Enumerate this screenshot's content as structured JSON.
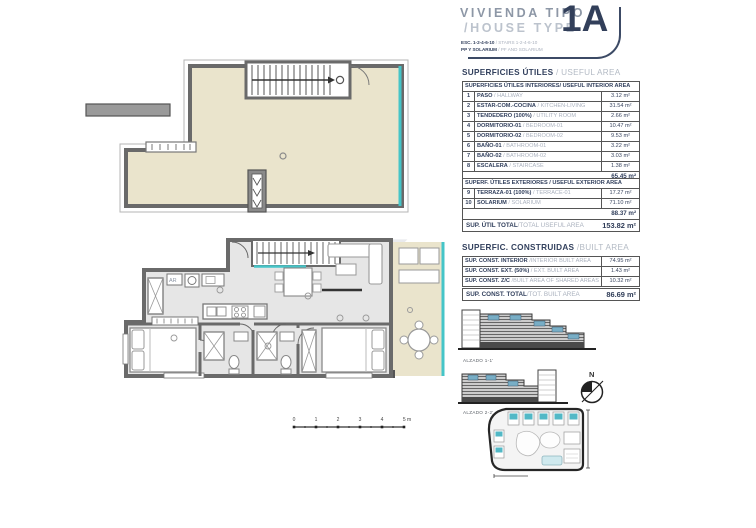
{
  "title": {
    "line1": "VIVIENDA TIPO",
    "line2": "/HOUSE TYPE",
    "unit_code": "1A",
    "sub1_es": "ESC. 1-2-4-6-10",
    "sub1_en": " / STAIRS 1-2-4-6-10",
    "sub2_es": "PP Y SOLARIUM",
    "sub2_en": " / PF AND SOLARIUM"
  },
  "useful_area": {
    "heading_es": "SUPERFICIES ÚTILES",
    "heading_en": " / USEFUL AREA",
    "interior_header": "SUPERFICIES ÚTILES INTERIORES/ USEFUL INTERIOR AREA",
    "interior_rows": [
      {
        "num": "1",
        "es": "PASO",
        "en": " / HALLWAY",
        "val": "3.12 m²"
      },
      {
        "num": "2",
        "es": "ESTAR-COM.-COCINA",
        "en": " / KITCHEN-LIVING",
        "val": "31.54 m²"
      },
      {
        "num": "3",
        "es": "TENDEDERO (100%)",
        "en": " / UTILITY ROOM",
        "val": "2.66 m²"
      },
      {
        "num": "4",
        "es": "DORMITORIO-01",
        "en": " / BEDROOM-01",
        "val": "10.47 m²"
      },
      {
        "num": "5",
        "es": "DORMITORIO-02",
        "en": " / BEDROOM-02",
        "val": "9.53 m²"
      },
      {
        "num": "6",
        "es": "BAÑO-01",
        "en": " / BATHROOM-01",
        "val": "3.22 m²"
      },
      {
        "num": "7",
        "es": "BAÑO-02",
        "en": " / BATHROOM-02",
        "val": "3.03 m²"
      },
      {
        "num": "8",
        "es": "ESCALERA",
        "en": " / STAIRCASE",
        "val": "1.38 m²"
      }
    ],
    "interior_subtotal": "65.45 m²",
    "exterior_header": "SUPERF. ÚTILES EXTERIORES / USEFUL EXTERIOR AREA",
    "exterior_rows": [
      {
        "num": "9",
        "es": "TERRAZA-01 (100%)",
        "en": " / TERRACE-01",
        "val": "17.27 m²"
      },
      {
        "num": "10",
        "es": "SOLARIUM",
        "en": " / SOLARIUM",
        "val": "71.10 m²"
      }
    ],
    "exterior_subtotal": "88.37 m²",
    "total_es": "SUP. ÚTIL TOTAL",
    "total_en": "/TOTAL USEFUL AREA",
    "total_val": "153.82 m²"
  },
  "built_area": {
    "heading_es": "SUPERFIC. CONSTRUIDAS",
    "heading_en": " /BUILT AREA",
    "rows": [
      {
        "es": "SUP. CONST. INTERIOR",
        "en": " /INTERIOR BUILT AREA",
        "val": "74.95 m²"
      },
      {
        "es": "SUP. CONST. EXT. (50%)",
        "en": " / EXT. BUILT AREA",
        "val": "1.43 m²"
      },
      {
        "es": "SUP. CONST. Z/C",
        "en": " /BUILT AREA OF SHARED AREAS",
        "val": "10.32 m²"
      }
    ],
    "total_es": "SUP. CONST. TOTAL",
    "total_en": "/TOT. BUILT AREA",
    "total_val": "86.69 m²"
  },
  "drawings": {
    "elevation1_label": "ALZADO 1-1'",
    "elevation2_label": "ALZADO 2-2'",
    "compass_n": "N",
    "ar_label": "AR",
    "watermark": "K",
    "scale_ticks": [
      "0",
      "1",
      "2",
      "3",
      "4",
      "5 m"
    ]
  },
  "colors": {
    "navy": "#33415E",
    "teal": "#45C5C8",
    "beige": "#EAE4CC",
    "wall_gray": "#6A6A6A",
    "floor_gray": "#E6E6E6",
    "light_text": "#AAB1BE"
  }
}
